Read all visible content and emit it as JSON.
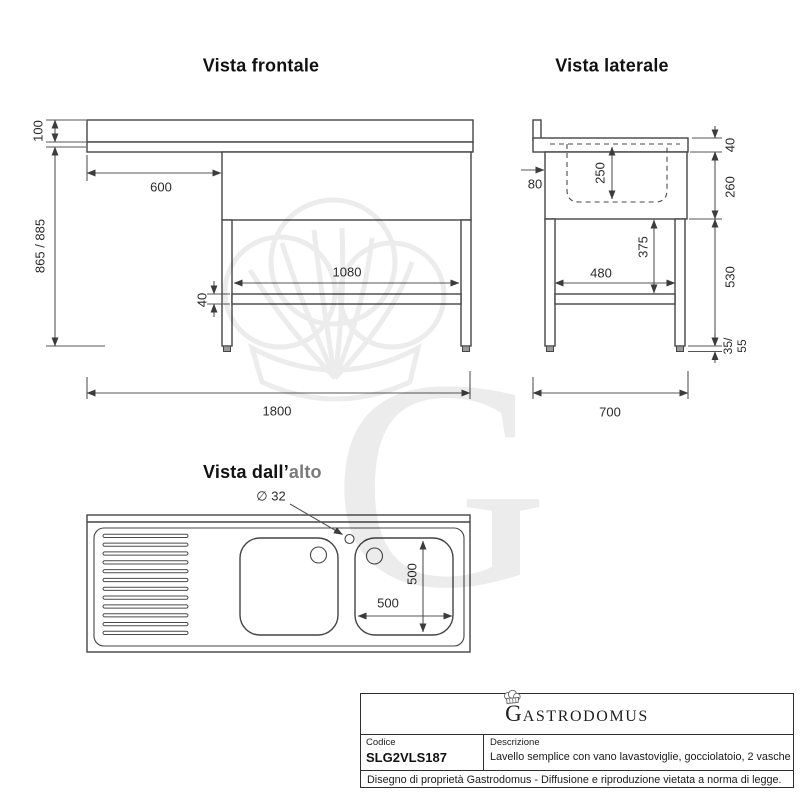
{
  "titles": {
    "front": "Vista frontale",
    "side": "Vista laterale",
    "top_prefix": "Vista dall’",
    "top_suffix": "alto"
  },
  "front_view": {
    "dims": {
      "backsplash_height": "100",
      "total_height": "865 / 885",
      "dishwasher_width": "600",
      "brace_length": "1080",
      "brace_height": "40",
      "total_width": "1800"
    }
  },
  "side_view": {
    "dims": {
      "front_offset": "80",
      "basin_depth": "250",
      "top_height": "40",
      "body_height": "260",
      "leg_to_brace": "375",
      "brace_depth": "480",
      "leg_height": "530",
      "foot_min": "35/",
      "foot_max": "55",
      "total_depth": "700"
    }
  },
  "top_view": {
    "dims": {
      "tap_hole_diameter": "∅ 32",
      "basin_width": "500",
      "basin_length": "500"
    }
  },
  "watermark": {
    "letter": "G"
  },
  "title_block": {
    "brand_initial": "G",
    "brand_rest": "ASTRODOMUS",
    "code_label": "Codice",
    "code_value": "SLG2VLS187",
    "description_label": "Descrizione",
    "description_value": "Lavello semplice con vano lavastoviglie, gocciolatoio, 2 vasche",
    "footer": "Disegno di proprietà Gastrodomus - Diffusione e riproduzione vietata a norma di legge."
  },
  "colors": {
    "line": "#454545",
    "dim_line": "#555555",
    "watermark": "#ececec",
    "gray_text": "#7a7a7a"
  }
}
